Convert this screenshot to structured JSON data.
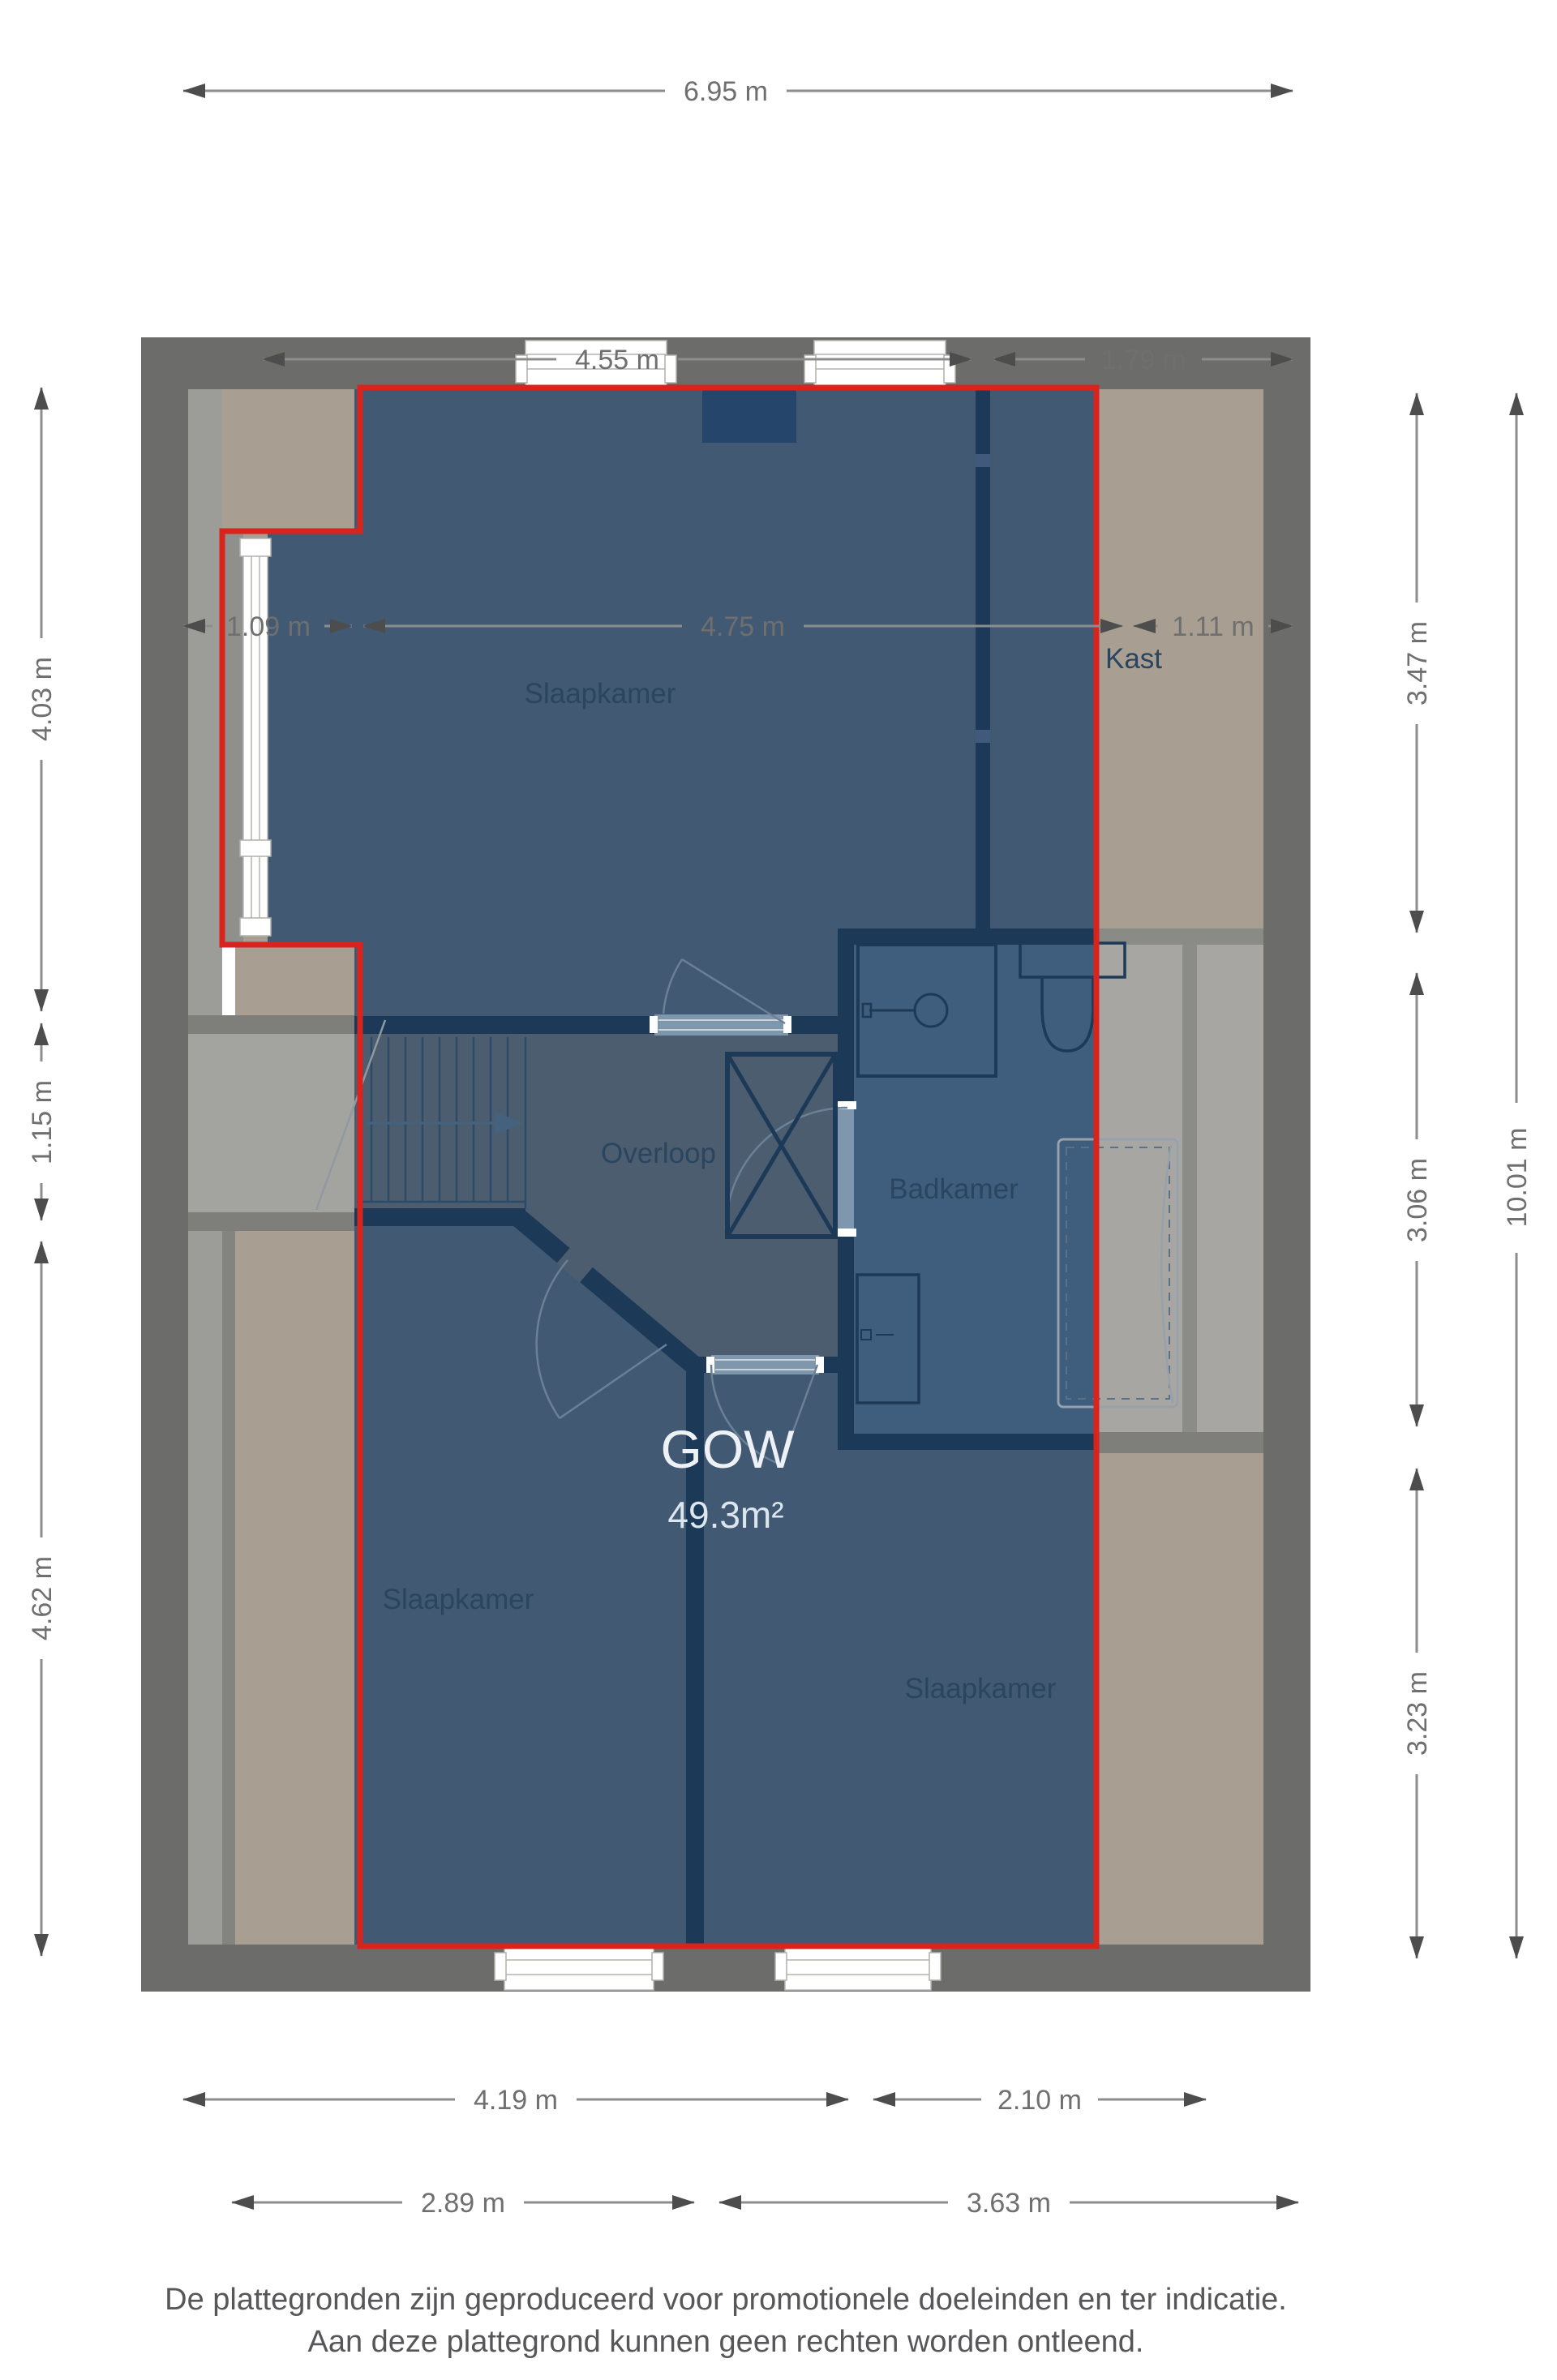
{
  "plan": {
    "highlight": {
      "label": "GOW",
      "area": "49.3m²"
    },
    "rooms": {
      "bedroom_top": "Slaapkamer",
      "closet": "Kast",
      "landing": "Overloop",
      "bathroom": "Badkamer",
      "bedroom_bottom_left": "Slaapkamer",
      "bedroom_bottom_right": "Slaapkamer"
    },
    "dims": {
      "top_total": "6.95 m",
      "top_row2_left": "4.55 m",
      "top_row2_right": "1.79 m",
      "top_row3_left": "1.09 m",
      "top_row3_mid": "4.75 m",
      "top_row3_right": "1.11 m",
      "left_top": "4.03 m",
      "left_mid": "1.15 m",
      "left_bottom": "4.62 m",
      "right_top": "3.47 m",
      "right_mid": "3.06 m",
      "right_bottom": "3.23 m",
      "right_total": "10.01 m",
      "bottom_row1_left": "4.19 m",
      "bottom_row1_right": "2.10 m",
      "bottom_row2_left": "2.89 m",
      "bottom_row2_right": "3.63 m"
    },
    "colors": {
      "highlight_outline": "#d9231d",
      "outer_wall": "#6c6c6a",
      "inner_wall": "#1c3a57",
      "floor_tan": "#a89e91",
      "floor_gray": "#9c9c98",
      "room_blue": "#415972",
      "landing_blue": "#4b5d6e",
      "bathroom_blue": "#3f5d7c",
      "chimney_navy": "#25456a",
      "label_dark": "#2a455f",
      "label_light": "#eef2f6",
      "dim_text": "#6f6f6f"
    }
  },
  "footer": {
    "line1": "De plattegronden zijn geproduceerd voor promotionele doeleinden en ter indicatie.",
    "line2": "Aan deze plattegrond kunnen geen rechten worden ontleend."
  }
}
